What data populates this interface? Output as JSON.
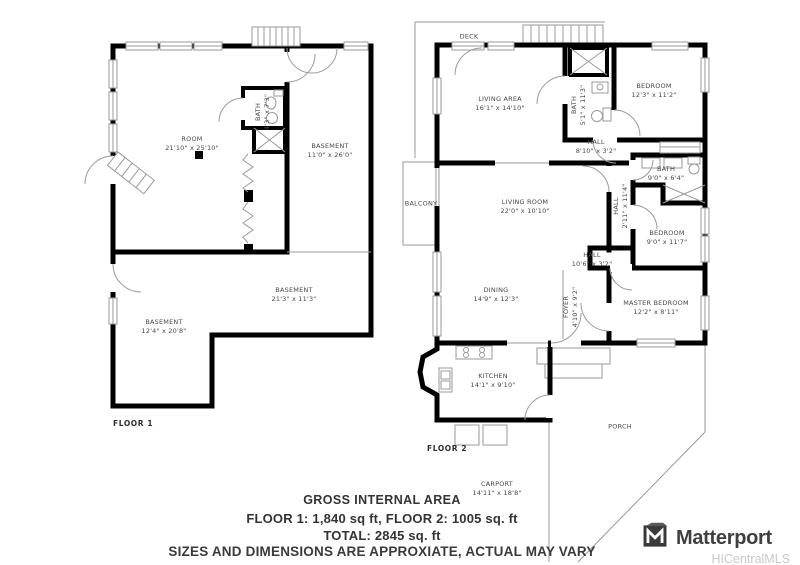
{
  "colors": {
    "wall": "#000000",
    "thin": "#9a9a9a",
    "label": "#474747",
    "footer": "#333333",
    "brand": "#3f3f3f",
    "brand_sub": "#c9c9c9"
  },
  "floor1": {
    "caption": "FLOOR 1",
    "rooms": {
      "room": {
        "name": "ROOM",
        "dims": "21'10\" x 25'10\""
      },
      "bath": {
        "name": "BATH",
        "dims": "4'3\" x 7'3\""
      },
      "basement_right": {
        "name": "BASEMENT",
        "dims": "11'0\" x 26'0\""
      },
      "basement_mid": {
        "name": "BASEMENT",
        "dims": "21'3\" x 11'3\""
      },
      "basement_left": {
        "name": "BASEMENT",
        "dims": "12'4\" x 20'8\""
      }
    }
  },
  "floor2": {
    "caption": "FLOOR 2",
    "rooms": {
      "deck": {
        "name": "DECK"
      },
      "living_area": {
        "name": "LIVING AREA",
        "dims": "16'1\" x 14'10\""
      },
      "bath_top": {
        "name": "BATH",
        "dims": "5'1\" x 11'3\""
      },
      "bedroom_top": {
        "name": "BEDROOM",
        "dims": "12'3\" x 11'2\""
      },
      "hall_top": {
        "name": "HALL",
        "dims": "8'10\" x 3'2\""
      },
      "balcony": {
        "name": "BALCONY"
      },
      "living_room": {
        "name": "LIVING ROOM",
        "dims": "22'0\" x 10'10\""
      },
      "hall_mid": {
        "name": "HALL",
        "dims": "2'11\" x 11'4\""
      },
      "bath_mid": {
        "name": "BATH",
        "dims": "9'0\" x 6'4\""
      },
      "bedroom_mid": {
        "name": "BEDROOM",
        "dims": "9'0\" x 11'7\""
      },
      "hall_lower": {
        "name": "HALL",
        "dims": "10'6\" x 3'2\""
      },
      "dining": {
        "name": "DINING",
        "dims": "14'9\" x 12'3\""
      },
      "foyer": {
        "name": "FOYER",
        "dims": "4'10\" x 9'2\""
      },
      "master": {
        "name": "MASTER BEDROOM",
        "dims": "12'2\" x 8'11\""
      },
      "kitchen": {
        "name": "KITCHEN",
        "dims": "14'1\" x 9'10\""
      },
      "porch": {
        "name": "PORCH"
      },
      "carport": {
        "name": "CARPORT",
        "dims": "14'11\" x 18'8\""
      }
    }
  },
  "footer": {
    "title": "GROSS INTERNAL AREA",
    "floors": "FLOOR 1:  1,840 sq ft, FLOOR 2:  1005 sq. ft",
    "total": "TOTAL:  2845 sq. ft",
    "disclaimer": "SIZES AND DIMENSIONS ARE APPROXIATE, ACTUAL MAY VARY"
  },
  "branding": {
    "logo": "Matterport",
    "mls": "HICentralMLS"
  }
}
